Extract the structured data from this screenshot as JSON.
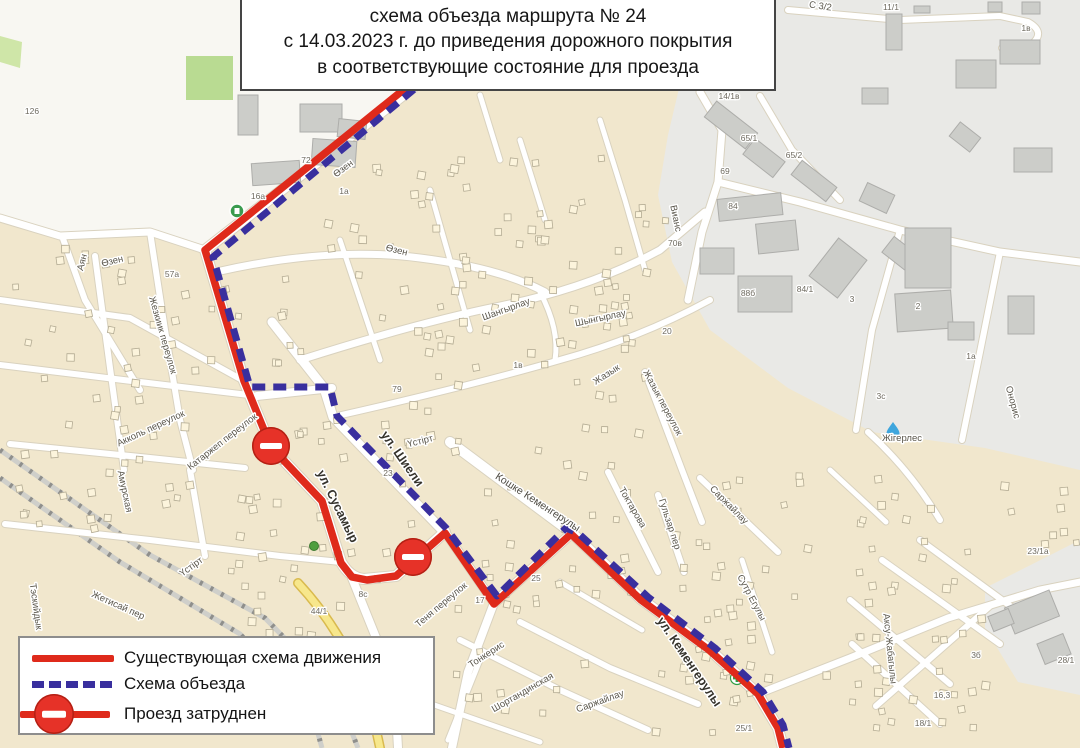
{
  "title": {
    "line1": "схема объезда маршрута № 24",
    "line2": "с 14.03.2023 г. до приведения дорожного покрытия",
    "line3": "в соответствующие состояние для проезда"
  },
  "legend": {
    "items": [
      {
        "label": "Существующая схема движения"
      },
      {
        "label": "Схема объезда"
      },
      {
        "label": "Проезд затруднен"
      }
    ]
  },
  "colors": {
    "existing_route": "#df2a1b",
    "detour_route": "#392f9e",
    "sign_red": "#e63228",
    "map_bg": "#f1e7cd",
    "industrial_zone": "#e9e9e6",
    "road": "#ffffff",
    "yellow_road": "#f7e78c",
    "green_area": "#b9db92",
    "label_text": "#5a564b"
  },
  "routes": {
    "existing": {
      "name": "Существующая схема движения",
      "color": "#df2a1b",
      "style": "solid",
      "points": [
        [
          423,
          74
        ],
        [
          205,
          250
        ],
        [
          244,
          381
        ],
        [
          271,
          447
        ],
        [
          322,
          501
        ],
        [
          341,
          563
        ],
        [
          352,
          577
        ],
        [
          367,
          580
        ],
        [
          396,
          576
        ],
        [
          445,
          533
        ],
        [
          494,
          604
        ],
        [
          571,
          534
        ],
        [
          641,
          600
        ],
        [
          709,
          650
        ],
        [
          758,
          694
        ],
        [
          778,
          728
        ],
        [
          783,
          748
        ]
      ]
    },
    "detour": {
      "name": "Схема объезда",
      "color": "#392f9e",
      "style": "dashed",
      "points": [
        [
          430,
          76
        ],
        [
          213,
          257
        ],
        [
          250,
          387
        ],
        [
          330,
          387
        ],
        [
          337,
          416
        ],
        [
          446,
          528
        ],
        [
          497,
          596
        ],
        [
          566,
          528
        ],
        [
          578,
          533
        ],
        [
          648,
          597
        ],
        [
          715,
          648
        ],
        [
          763,
          692
        ],
        [
          783,
          725
        ],
        [
          789,
          748
        ]
      ]
    }
  },
  "map": {
    "signs": [
      {
        "name": "no-entry-sign",
        "x": 271,
        "y": 446
      },
      {
        "name": "no-entry-sign",
        "x": 413,
        "y": 557
      }
    ],
    "street_labels": [
      {
        "text": "Өзен",
        "x": 345,
        "y": 171,
        "rot": -37,
        "cls": "s"
      },
      {
        "text": "Өзен",
        "x": 113,
        "y": 264,
        "rot": -14,
        "cls": "s"
      },
      {
        "text": "Өзен",
        "x": 396,
        "y": 253,
        "rot": 14,
        "cls": "s"
      },
      {
        "text": "Аян",
        "x": 85,
        "y": 263,
        "rot": -75,
        "cls": "s"
      },
      {
        "text": "Жезкиик переулок",
        "x": 160,
        "y": 336,
        "rot": 74,
        "cls": "s"
      },
      {
        "text": "Акколь переулок",
        "x": 152,
        "y": 431,
        "rot": -25,
        "cls": "s"
      },
      {
        "text": "Катаржеп переулок",
        "x": 224,
        "y": 444,
        "rot": -38,
        "cls": "s"
      },
      {
        "text": "Амурская",
        "x": 122,
        "y": 492,
        "rot": 78,
        "cls": "s"
      },
      {
        "text": "Үстірт",
        "x": 193,
        "y": 569,
        "rot": -36,
        "cls": "s"
      },
      {
        "text": "Жетисай пер",
        "x": 117,
        "y": 608,
        "rot": 24,
        "cls": "s"
      },
      {
        "text": "Тэскийдык",
        "x": 33,
        "y": 607,
        "rot": 82,
        "cls": "s"
      },
      {
        "text": "Шангырлау",
        "x": 507,
        "y": 312,
        "rot": -20,
        "cls": "s"
      },
      {
        "text": "Шынгырлау",
        "x": 601,
        "y": 321,
        "rot": -12,
        "cls": "s"
      },
      {
        "text": "Жазык",
        "x": 608,
        "y": 377,
        "rot": -33,
        "cls": "s"
      },
      {
        "text": "Жазык переулок",
        "x": 660,
        "y": 404,
        "rot": 62,
        "cls": "s"
      },
      {
        "text": "Кошке Кеменгерулы",
        "x": 536,
        "y": 505,
        "rot": 33,
        "cls": "m"
      },
      {
        "text": "Токтарова",
        "x": 630,
        "y": 509,
        "rot": 60,
        "cls": "s"
      },
      {
        "text": "Гульзар пер",
        "x": 667,
        "y": 525,
        "rot": 72,
        "cls": "s"
      },
      {
        "text": "Саржайлау",
        "x": 727,
        "y": 507,
        "rot": 45,
        "cls": "s"
      },
      {
        "text": "Саржайлау",
        "x": 601,
        "y": 704,
        "rot": -20,
        "cls": "s"
      },
      {
        "text": "Шортандинская",
        "x": 524,
        "y": 695,
        "rot": -30,
        "cls": "s"
      },
      {
        "text": "Тонкерис",
        "x": 488,
        "y": 657,
        "rot": -33,
        "cls": "s"
      },
      {
        "text": "Теня переулок",
        "x": 443,
        "y": 607,
        "rot": -40,
        "cls": "s"
      },
      {
        "text": "Үстірт",
        "x": 421,
        "y": 444,
        "rot": -14,
        "cls": "s"
      },
      {
        "text": "Вианс",
        "x": 673,
        "y": 219,
        "rot": 78,
        "cls": "s"
      },
      {
        "text": "Сутр Егулы",
        "x": 749,
        "y": 599,
        "rot": 62,
        "cls": "s"
      },
      {
        "text": "Аксу-Жабагылы",
        "x": 887,
        "y": 649,
        "rot": 84,
        "cls": "s"
      },
      {
        "text": "Жігерлес",
        "x": 902,
        "y": 441,
        "rot": 0,
        "cls": "s"
      },
      {
        "text": "Онорис",
        "x": 1010,
        "y": 403,
        "rot": 75,
        "cls": "s"
      },
      {
        "text": "С 3/2",
        "x": 820,
        "y": 9,
        "rot": 8,
        "cls": "s"
      },
      {
        "text": "ул. Сусамыр",
        "x": 334,
        "y": 508,
        "rot": 64,
        "cls": "b"
      },
      {
        "text": "ул. Шиели",
        "x": 399,
        "y": 461,
        "rot": 55,
        "cls": "b"
      },
      {
        "text": "ул. Кеменгерулы",
        "x": 686,
        "y": 664,
        "rot": 56,
        "cls": "b"
      }
    ],
    "house_numbers": [
      {
        "text": "126",
        "x": 32,
        "y": 114
      },
      {
        "text": "72",
        "x": 306,
        "y": 163
      },
      {
        "text": "1а",
        "x": 344,
        "y": 194
      },
      {
        "text": "16а",
        "x": 258,
        "y": 199
      },
      {
        "text": "57а",
        "x": 172,
        "y": 277
      },
      {
        "text": "79",
        "x": 397,
        "y": 392
      },
      {
        "text": "23",
        "x": 388,
        "y": 476
      },
      {
        "text": "1в",
        "x": 518,
        "y": 368
      },
      {
        "text": "20",
        "x": 667,
        "y": 334
      },
      {
        "text": "17",
        "x": 480,
        "y": 603
      },
      {
        "text": "25",
        "x": 536,
        "y": 581
      },
      {
        "text": "44/1",
        "x": 319,
        "y": 614
      },
      {
        "text": "8с",
        "x": 363,
        "y": 597
      },
      {
        "text": "14/1в",
        "x": 729,
        "y": 99
      },
      {
        "text": "65/1",
        "x": 749,
        "y": 141
      },
      {
        "text": "65/2",
        "x": 794,
        "y": 158
      },
      {
        "text": "69",
        "x": 725,
        "y": 174
      },
      {
        "text": "84",
        "x": 733,
        "y": 209
      },
      {
        "text": "70в",
        "x": 675,
        "y": 246
      },
      {
        "text": "88б",
        "x": 748,
        "y": 296
      },
      {
        "text": "84/1",
        "x": 805,
        "y": 292
      },
      {
        "text": "3",
        "x": 852,
        "y": 302
      },
      {
        "text": "2",
        "x": 918,
        "y": 309
      },
      {
        "text": "1а",
        "x": 971,
        "y": 359
      },
      {
        "text": "3с",
        "x": 881,
        "y": 399
      },
      {
        "text": "11/1",
        "x": 891,
        "y": 10
      },
      {
        "text": "1в",
        "x": 1026,
        "y": 31
      },
      {
        "text": "23/1а",
        "x": 1038,
        "y": 554
      },
      {
        "text": "3б",
        "x": 976,
        "y": 658
      },
      {
        "text": "16,3",
        "x": 942,
        "y": 698
      },
      {
        "text": "18/1",
        "x": 923,
        "y": 726
      },
      {
        "text": "28/1",
        "x": 1066,
        "y": 663
      },
      {
        "text": "25/1",
        "x": 744,
        "y": 731
      }
    ],
    "icons": [
      {
        "type": "fuel-station-icon",
        "x": 237,
        "y": 211
      },
      {
        "type": "tree-icon",
        "x": 314,
        "y": 546
      },
      {
        "type": "pharmacy-icon",
        "x": 737,
        "y": 678
      },
      {
        "type": "water-icon",
        "x": 893,
        "y": 430
      }
    ]
  }
}
